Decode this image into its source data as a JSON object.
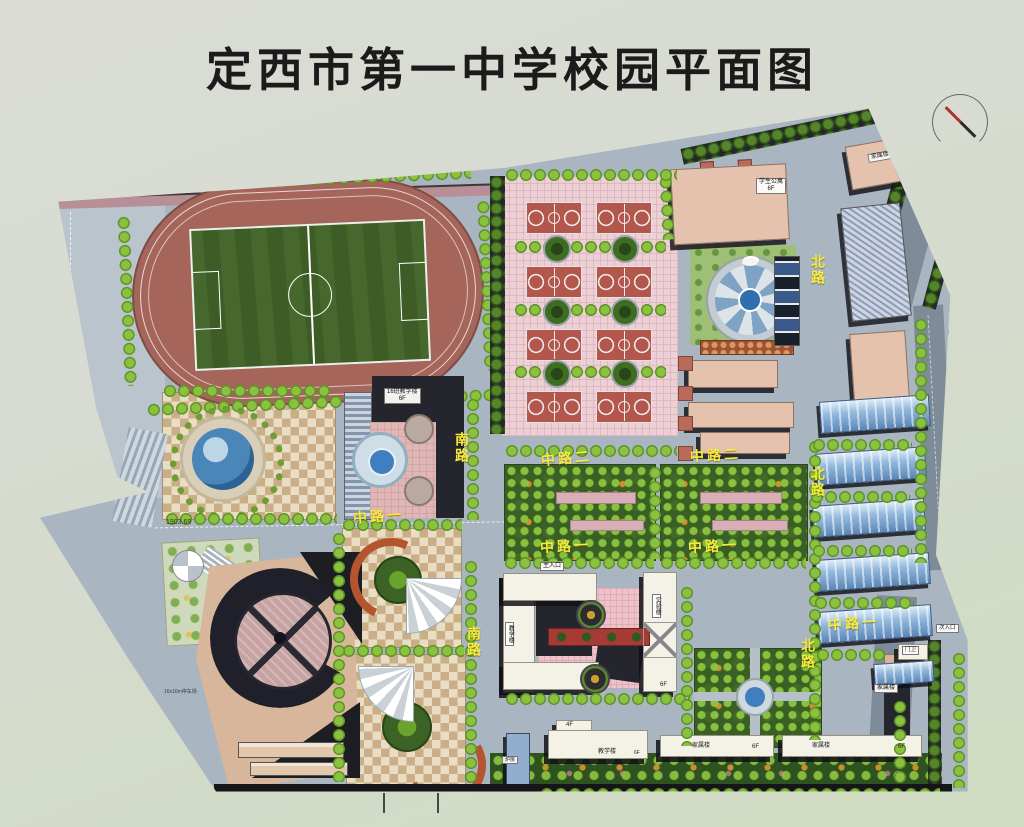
{
  "title": "定西市第一中学校园平面图",
  "roads": [
    {
      "id": "south-upper",
      "text": "南路"
    },
    {
      "id": "south-lower",
      "text": "南路"
    },
    {
      "id": "middle1-west",
      "text": "中路一"
    },
    {
      "id": "middle1-center",
      "text": "中路一"
    },
    {
      "id": "middle1-east",
      "text": "中路一"
    },
    {
      "id": "middle1-far-east",
      "text": "中路一"
    },
    {
      "id": "middle2-west",
      "text": "中路二"
    },
    {
      "id": "middle2-east",
      "text": "中路二"
    },
    {
      "id": "north-upper",
      "text": "北路"
    },
    {
      "id": "north-middle",
      "text": "北路"
    },
    {
      "id": "north-lower",
      "text": "北路"
    }
  ],
  "buildings": {
    "student_apartment": {
      "label": "学生公寓",
      "floors": "6F"
    },
    "family_top": {
      "label": "家属楼"
    },
    "classroom_16": {
      "label": "16班教学楼",
      "floors": "6F"
    },
    "teaching_main": {
      "label": "教学楼"
    },
    "lab": {
      "label": "实验楼",
      "floors": "6F"
    },
    "teaching_south": {
      "label": "教学楼",
      "floors": "6F"
    },
    "annex": {
      "floors": "4F"
    },
    "family_south_1": {
      "label": "家属楼",
      "floors": "6F"
    },
    "family_south_2": {
      "label": "家属楼",
      "floors": "6F"
    },
    "family_east": {
      "label": "家属楼"
    },
    "boiler": {
      "label": "炉房"
    },
    "guard": {
      "label": "门卫"
    }
  },
  "entrances": {
    "main": "主入口",
    "secondary": "次入口"
  },
  "annotations": {
    "elevation": "1903.69",
    "parking_pad": "16x16m停车场"
  },
  "colors": {
    "map_base": "#a9b5c0",
    "track": "#a5655b",
    "field_green": "#47682c",
    "court_red": "#b3564c",
    "court_paving": "#ecd0d5",
    "tree_green": "#8ac13e",
    "road_label_yellow": "#f4eb3e",
    "building_pink": "#e4c2ad",
    "building_white": "#f4f1e7",
    "greenhouse_blue": "#94bade",
    "water_blue": "#3f7fc0",
    "checker_tan": "#c9ae87",
    "garden_green": "#3a5f24"
  }
}
